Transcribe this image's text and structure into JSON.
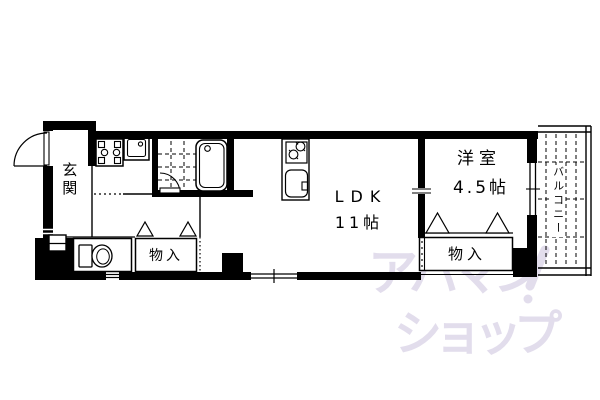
{
  "rooms": {
    "genkan": {
      "label": "玄関"
    },
    "ldk": {
      "label": "LDK",
      "size": "11帖"
    },
    "western_room": {
      "label": "洋室",
      "size": "4.5帖"
    },
    "balcony": {
      "label": "バルコニー"
    },
    "storage_left": {
      "label": "物入"
    },
    "storage_right": {
      "label": "物入"
    }
  },
  "watermark": {
    "line1": "アパマン",
    "line2": "ショップ",
    "color": "#E2DDEC"
  },
  "colors": {
    "line": "#000000",
    "background": "#ffffff",
    "watermark": "#E2DDEC"
  },
  "icons": [
    "entrance-door-arc-icon",
    "bath-door-arc-icon",
    "bathtub-icon",
    "bath-tile-floor",
    "washing-machine-pan-icon",
    "washbasin-icon",
    "toilet-icon",
    "stove-icon",
    "kitchen-sink-icon",
    "closet-door-triangle-icon",
    "window-marker",
    "pipe-space-box",
    "watermark-swoosh-icon"
  ]
}
